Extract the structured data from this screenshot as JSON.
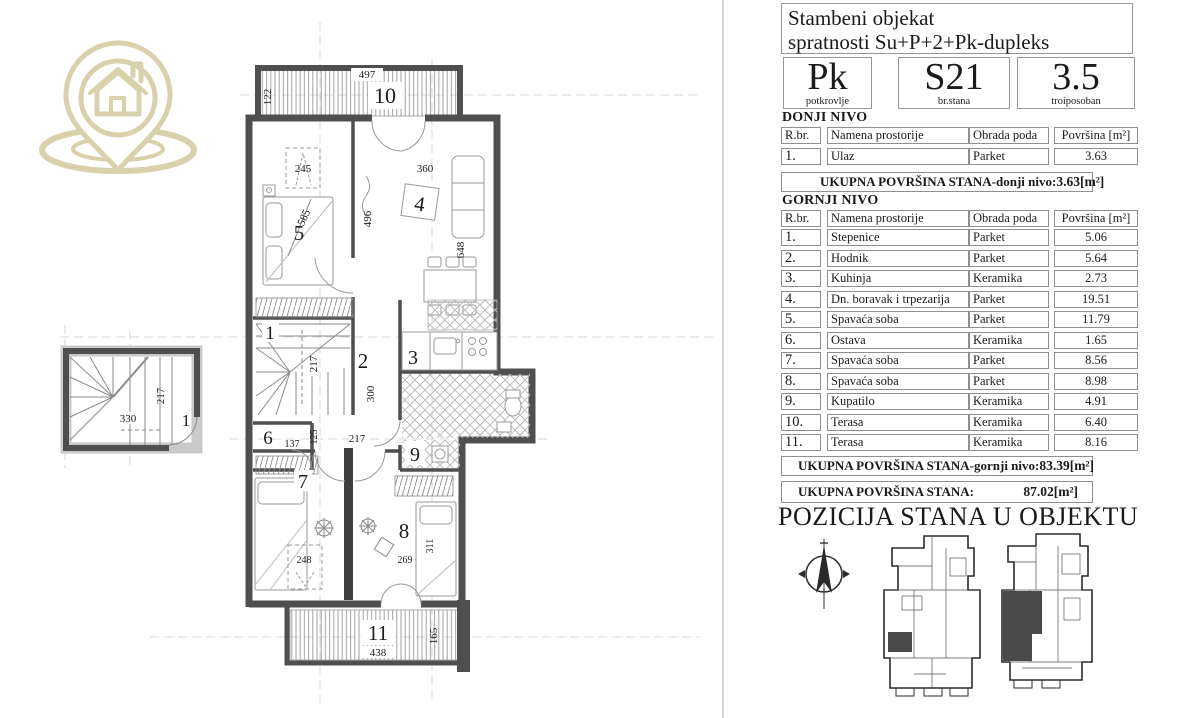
{
  "header": {
    "title_line1": "Stambeni objekat",
    "title_line2": "spratnosti Su+P+2+Pk-dupleks"
  },
  "unit": {
    "floor_code": "Pk",
    "floor_label": "potkrovlje",
    "number_code": "S21",
    "number_label": "br.stana",
    "rooms_code": "3.5",
    "rooms_label": "troiposoban"
  },
  "lower_level": {
    "section_label": "DONJI NIVO",
    "headers": [
      "R.br.",
      "Namena prostorije",
      "Obrada poda",
      "Površina [m²]"
    ],
    "rows": [
      [
        "1.",
        "Ulaz",
        "Parket",
        "3.63"
      ]
    ],
    "total_label": "UKUPNA POVRŠINA STANA-donji nivo:",
    "total_value": "3.63[m²]"
  },
  "upper_level": {
    "section_label": "GORNJI NIVO",
    "headers": [
      "R.br.",
      "Namena prostorije",
      "Obrada poda",
      "Površina [m²]"
    ],
    "rows": [
      [
        "1.",
        "Stepenice",
        "Parket",
        "5.06"
      ],
      [
        "2.",
        "Hodnik",
        "Parket",
        "5.64"
      ],
      [
        "3.",
        "Kuhinja",
        "Keramika",
        "2.73"
      ],
      [
        "4.",
        "Dn. boravak i trpezarija",
        "Parket",
        "19.51"
      ],
      [
        "5.",
        "Spavaća soba",
        "Parket",
        "11.79"
      ],
      [
        "6.",
        "Ostava",
        "Keramika",
        "1.65"
      ],
      [
        "7.",
        "Spavaća soba",
        "Parket",
        "8.56"
      ],
      [
        "8.",
        "Spavaća soba",
        "Parket",
        "8.98"
      ],
      [
        "9.",
        "Kupatilo",
        "Keramika",
        "4.91"
      ],
      [
        "10.",
        "Terasa",
        "Keramika",
        "6.40"
      ],
      [
        "11.",
        "Terasa",
        "Keramika",
        "8.16"
      ]
    ],
    "total_label": "UKUPNA POVRŠINA STANA-gornji nivo:",
    "total_value": "83.39[m²]"
  },
  "summary": {
    "total_label": "UKUPNA POVRŠINA STANA:",
    "total_value": "87.02[m²]"
  },
  "position": {
    "title": "POZICIJA STANA U OBJEKTU"
  },
  "floor_plan": {
    "rooms": {
      "r1": "1",
      "r2": "2",
      "r3": "3",
      "r4": "4",
      "r5": "5",
      "r6": "6",
      "r7": "7",
      "r8": "8",
      "r9": "9",
      "r10": "10",
      "r11": "11",
      "entry": "1"
    },
    "dims": {
      "terrace_top_w": "497",
      "terrace_top_d": "122",
      "wardrobe": "245",
      "bed": "585",
      "living_w": "360",
      "living_d": "496",
      "living_h": "648",
      "stairs_d": "217",
      "hall_d": "300",
      "hall_w": "217",
      "ostava_w": "137",
      "ostava_d": "125",
      "desk": "248",
      "room8_w": "269",
      "room8_d": "311",
      "terrace_bottom_w": "438",
      "terrace_bottom_d": "165",
      "entry_w": "330",
      "entry_d": "217"
    }
  },
  "colors": {
    "logo_accent": "#d9d0ac",
    "wall": "#4f4f4f",
    "highlight_unit": "#4a4a4a"
  }
}
